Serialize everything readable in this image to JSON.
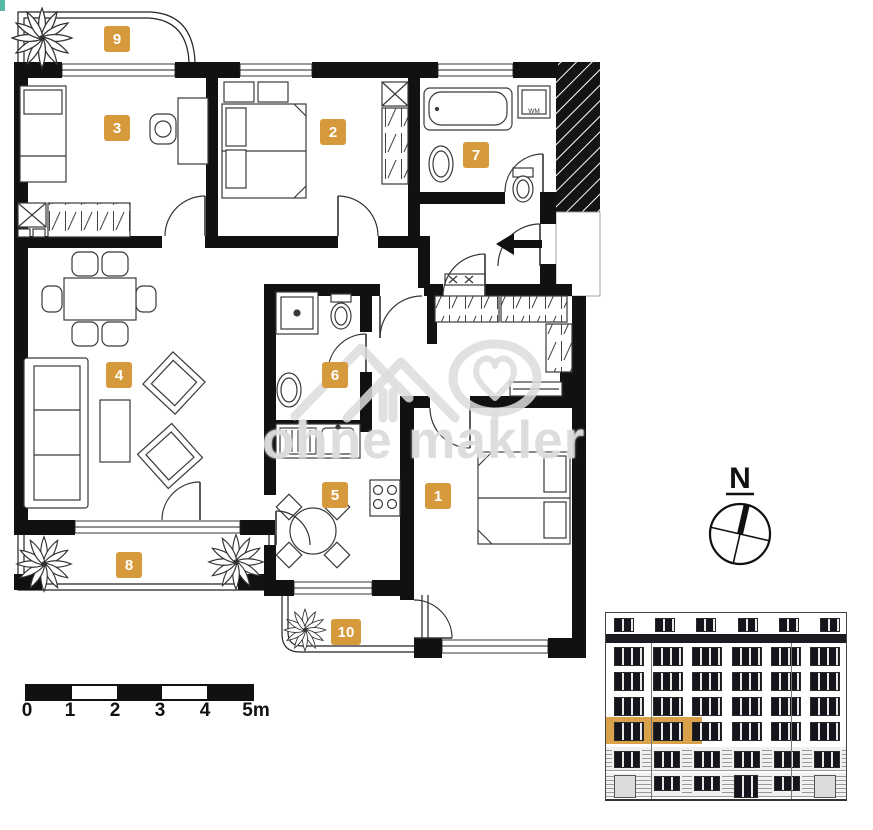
{
  "accent_color": "#d69a3c",
  "watermark": {
    "text": "ohne makler",
    "logo": "house-roofs-and-tree-heart"
  },
  "rooms": [
    "1",
    "2",
    "3",
    "4",
    "5",
    "6",
    "7",
    "8",
    "9",
    "10"
  ],
  "appliance_labels": {
    "washing_machine": "WM"
  },
  "compass": {
    "north": "N"
  },
  "scale_bar": {
    "ticks": [
      "0",
      "1",
      "2",
      "3",
      "4",
      "5m"
    ]
  },
  "icons": {
    "plant_icon": "radial-leaf-cluster",
    "entry_arrow_icon": "solid-left-arrow",
    "compass_icon": "circle-with-cross-and-north-needle"
  },
  "building_elevation": {
    "x": 605,
    "y": 612,
    "w": 240,
    "h": 186,
    "attic": {
      "y": 5,
      "h": 12,
      "count": 6,
      "win_w": 18
    },
    "cornice": {
      "y": 21,
      "h": 9
    },
    "floor_rows": [
      34,
      59,
      84,
      109
    ],
    "floor_win": {
      "w": 28,
      "h": 17,
      "count": 6
    },
    "highlight": {
      "row_index": 3,
      "x": 0,
      "w": 96,
      "pad": 5
    },
    "mezzanine": {
      "y": 138,
      "h": 15,
      "count": 6,
      "win_w": 24
    },
    "ground": {
      "y": 160,
      "h": 24,
      "items": [
        "door",
        "win",
        "win",
        "door_dark",
        "win",
        "door"
      ]
    },
    "seams": [
      45,
      185
    ],
    "highlight_color": "#d9a14a"
  }
}
